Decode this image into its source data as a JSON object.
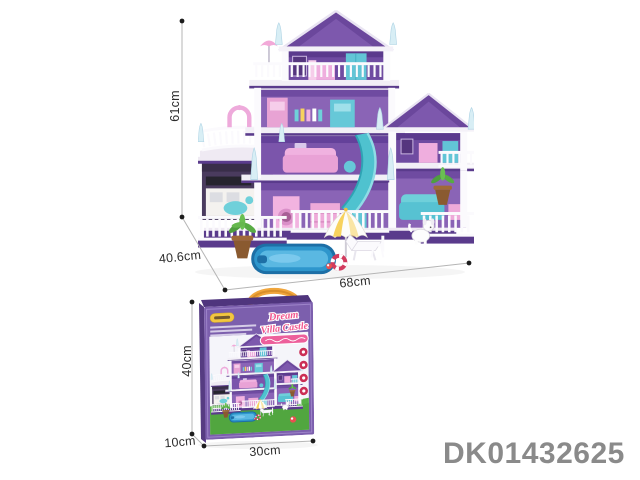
{
  "product_code": "DK01432625",
  "assembled_house": {
    "height_label": "61cm",
    "depth_label": "40.6cm",
    "width_label": "68cm"
  },
  "box": {
    "title_line1": "Dream",
    "title_line2": "Villa Castle",
    "height_label": "40cm",
    "depth_label": "10cm",
    "width_label": "30cm"
  },
  "colors": {
    "box_purple": "#7c5fad",
    "roof_purple": "#6b479c",
    "wall_purple": "#8a64b6",
    "title_pink": "#f2568e",
    "handle_yellow": "#f1a63c",
    "pool_blue": "#2e96cc",
    "grass_green": "#57b045",
    "furniture_pink": "#eeaad9",
    "furniture_teal": "#62c5d6",
    "code_gray": "#8a8a8a",
    "dimension_line_gray": "#b5b5b5"
  }
}
